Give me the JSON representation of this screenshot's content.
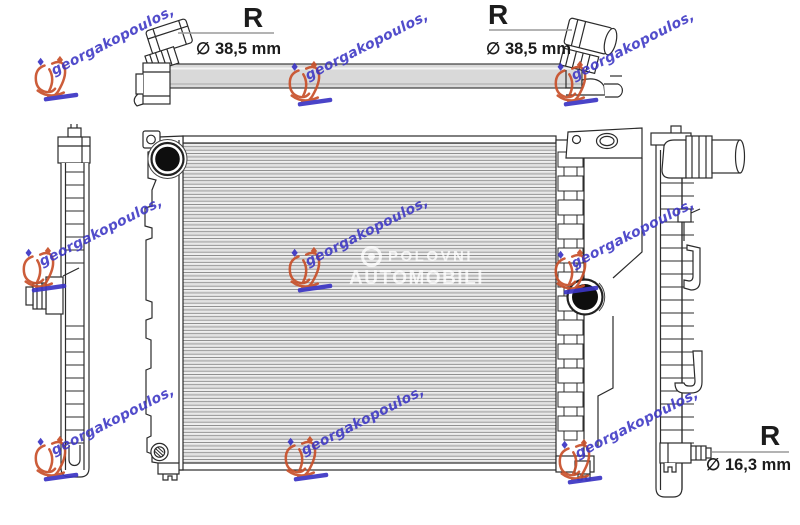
{
  "annotations": [
    {
      "position": "top-left",
      "label": "R",
      "dimension": "∅ 38,5 mm"
    },
    {
      "position": "top-right",
      "label": "R",
      "dimension": "∅ 38,5 mm"
    },
    {
      "position": "bottom-right",
      "label": "R",
      "dimension": "∅ 16,3 mm"
    }
  ],
  "watermarks": {
    "seller": {
      "text": "georgakopoulos,"
    },
    "site": {
      "line1": "POLOVNI",
      "line2": "AUTOMOBILI"
    }
  },
  "colors": {
    "ink": "#1c1c1c",
    "line": "#2b2b2b",
    "leader": "#9a9a9a",
    "tube-gray": "#d9d9d9",
    "port-dark": "#0e0e0e",
    "wm-blue": "#3b35c4",
    "wm-orange": "#c8502a",
    "site-white": "#ffffff"
  }
}
